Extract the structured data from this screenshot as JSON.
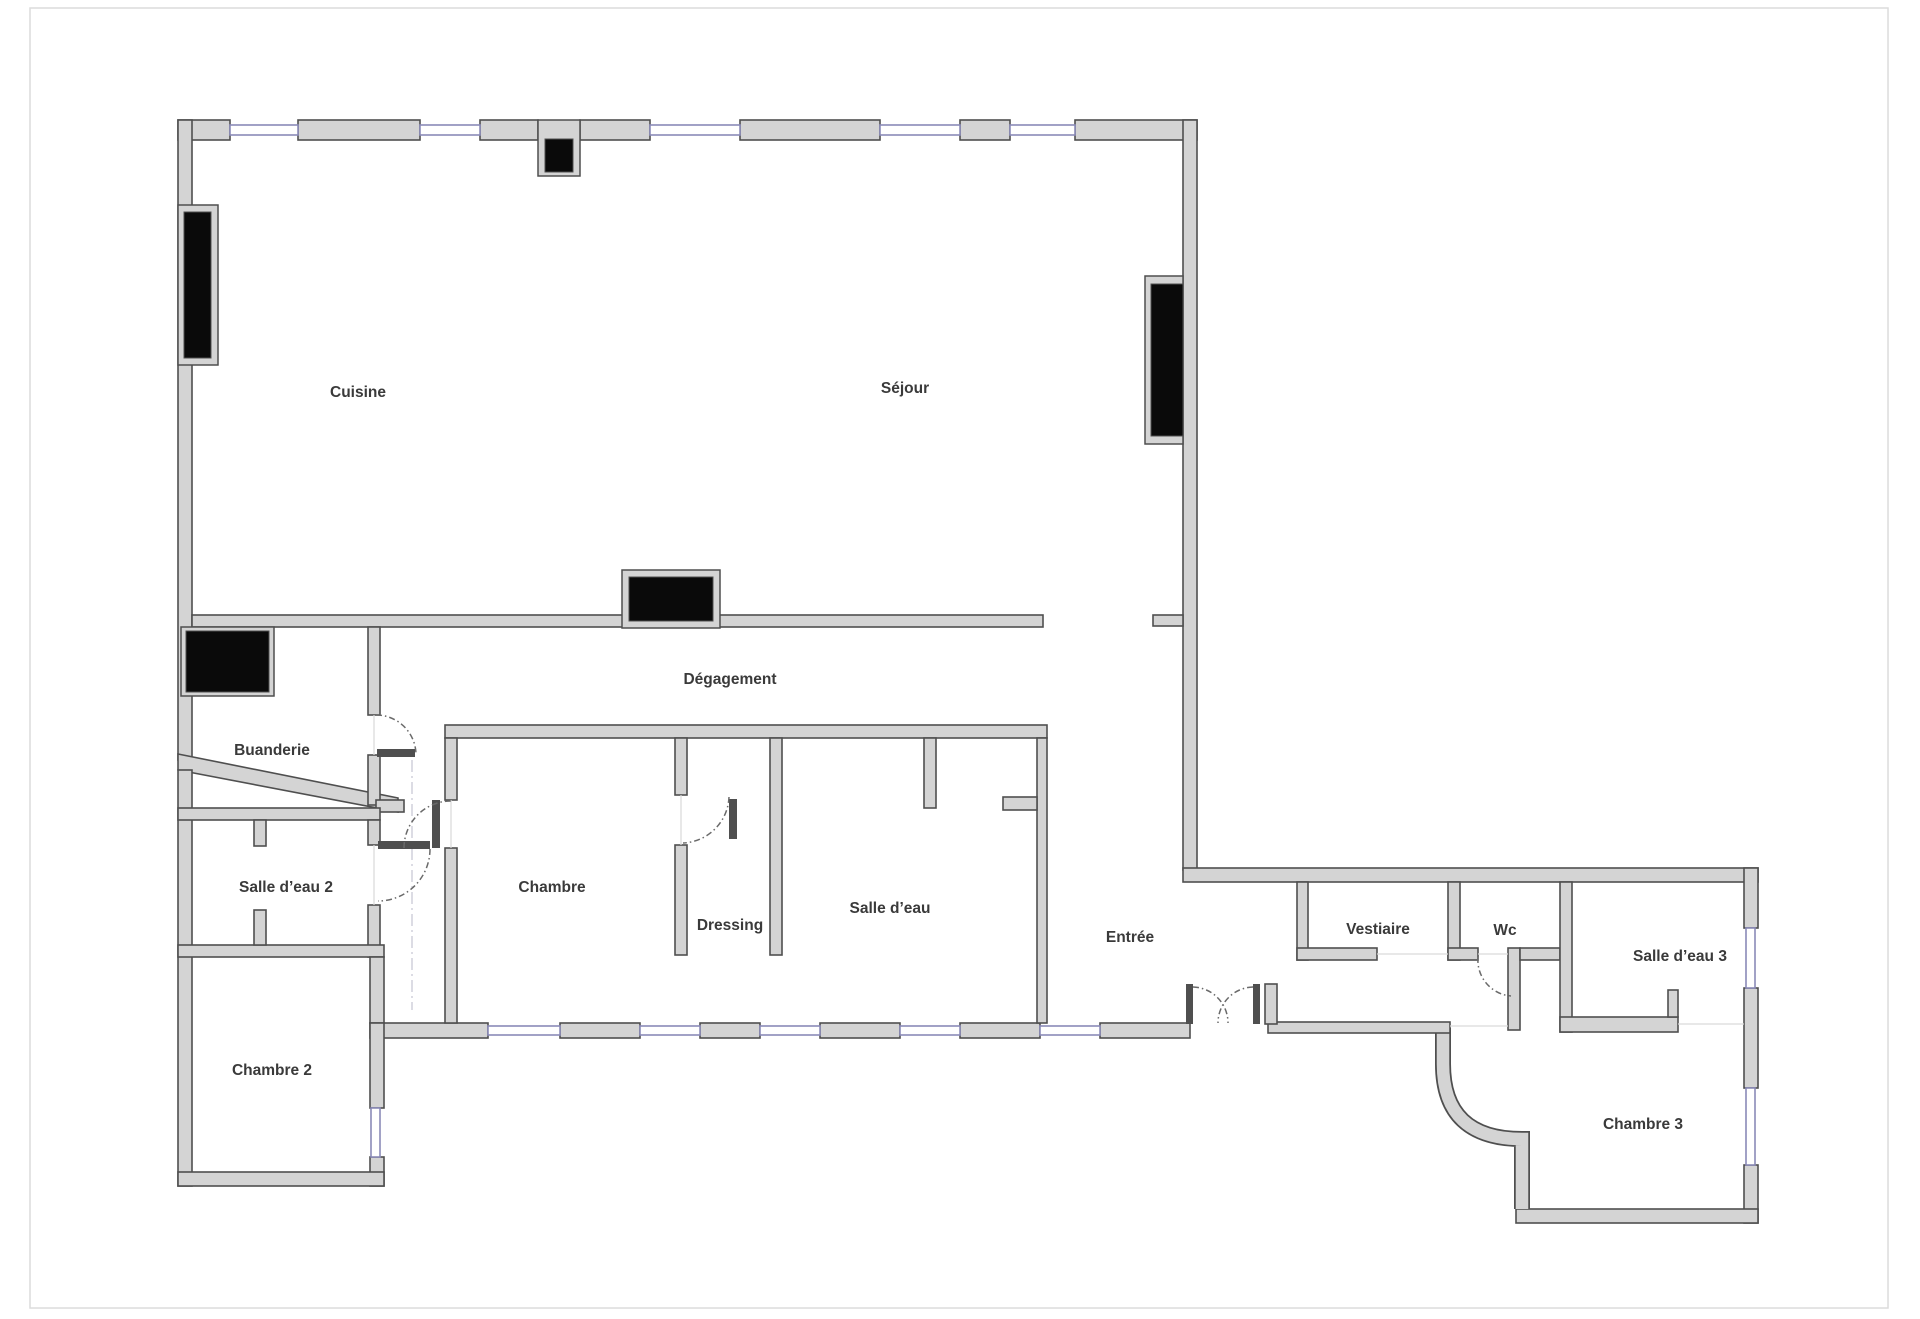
{
  "document_type": "floor-plan",
  "colors": {
    "wall_fill": "#d4d4d4",
    "wall_stroke": "#4f4f4f",
    "window_color": "#8a8ab8",
    "fixture_color": "#0a0a0a",
    "dash_color": "#b9b9c9",
    "label_color": "#3a3a3a",
    "page_border": "#dcdcdc",
    "bg": "#ffffff"
  },
  "rooms": [
    {
      "id": "cuisine",
      "label": "Cuisine"
    },
    {
      "id": "sejour",
      "label": "Séjour"
    },
    {
      "id": "degagement",
      "label": "Dégagement"
    },
    {
      "id": "buanderie",
      "label": "Buanderie"
    },
    {
      "id": "salle-deau-2",
      "label": "Salle d’eau 2"
    },
    {
      "id": "chambre",
      "label": "Chambre"
    },
    {
      "id": "dressing",
      "label": "Dressing"
    },
    {
      "id": "salle-deau",
      "label": "Salle d’eau"
    },
    {
      "id": "chambre-2",
      "label": "Chambre 2"
    },
    {
      "id": "entree",
      "label": "Entrée"
    },
    {
      "id": "vestiaire",
      "label": "Vestiaire"
    },
    {
      "id": "wc",
      "label": "Wc"
    },
    {
      "id": "salle-deau-3",
      "label": "Salle d’eau 3"
    },
    {
      "id": "chambre-3",
      "label": "Chambre 3"
    }
  ]
}
